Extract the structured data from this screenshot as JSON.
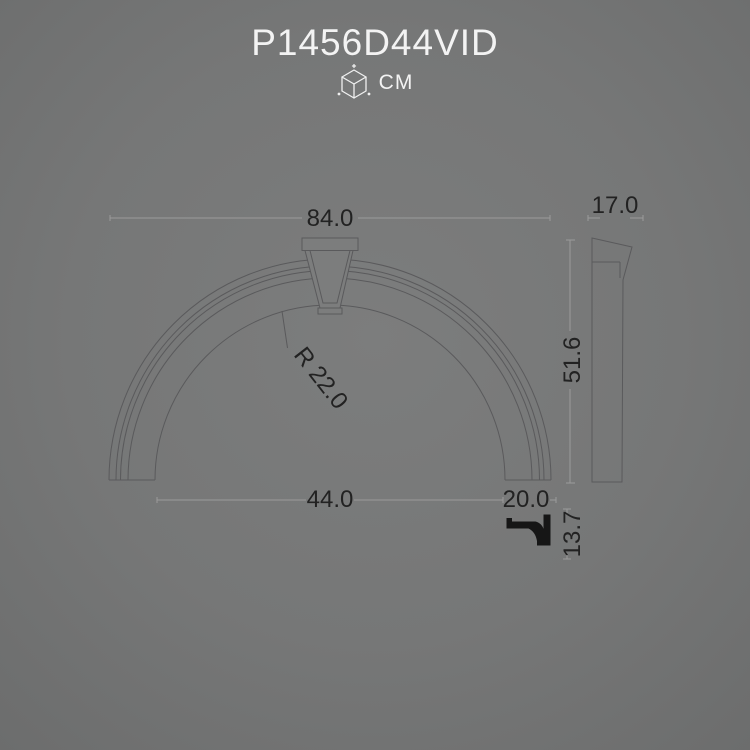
{
  "header": {
    "title": "P1456D44VID",
    "units_label": "CM",
    "cube_icon": "dimensions-cube-icon"
  },
  "colors": {
    "background_center": "#7c7d7d",
    "background_edge": "#6c6d6d",
    "outline": "#5a5a5c",
    "dimension_line": "#9b9b9b",
    "dimension_text": "#222222",
    "title_text": "#f3f3f3",
    "section_fill": "#161616"
  },
  "front_view": {
    "name": "arch front elevation",
    "dimensions": {
      "overall_width": "84.0",
      "arc_radius": "R 22.0",
      "inner_span": "44.0",
      "foot_width": "20.0"
    }
  },
  "side_view": {
    "name": "arch side profile",
    "dimensions": {
      "depth": "17.0",
      "height": "51.6"
    }
  },
  "profile_section": {
    "name": "moulding cross-section",
    "dimensions": {
      "height": "13.7"
    }
  }
}
